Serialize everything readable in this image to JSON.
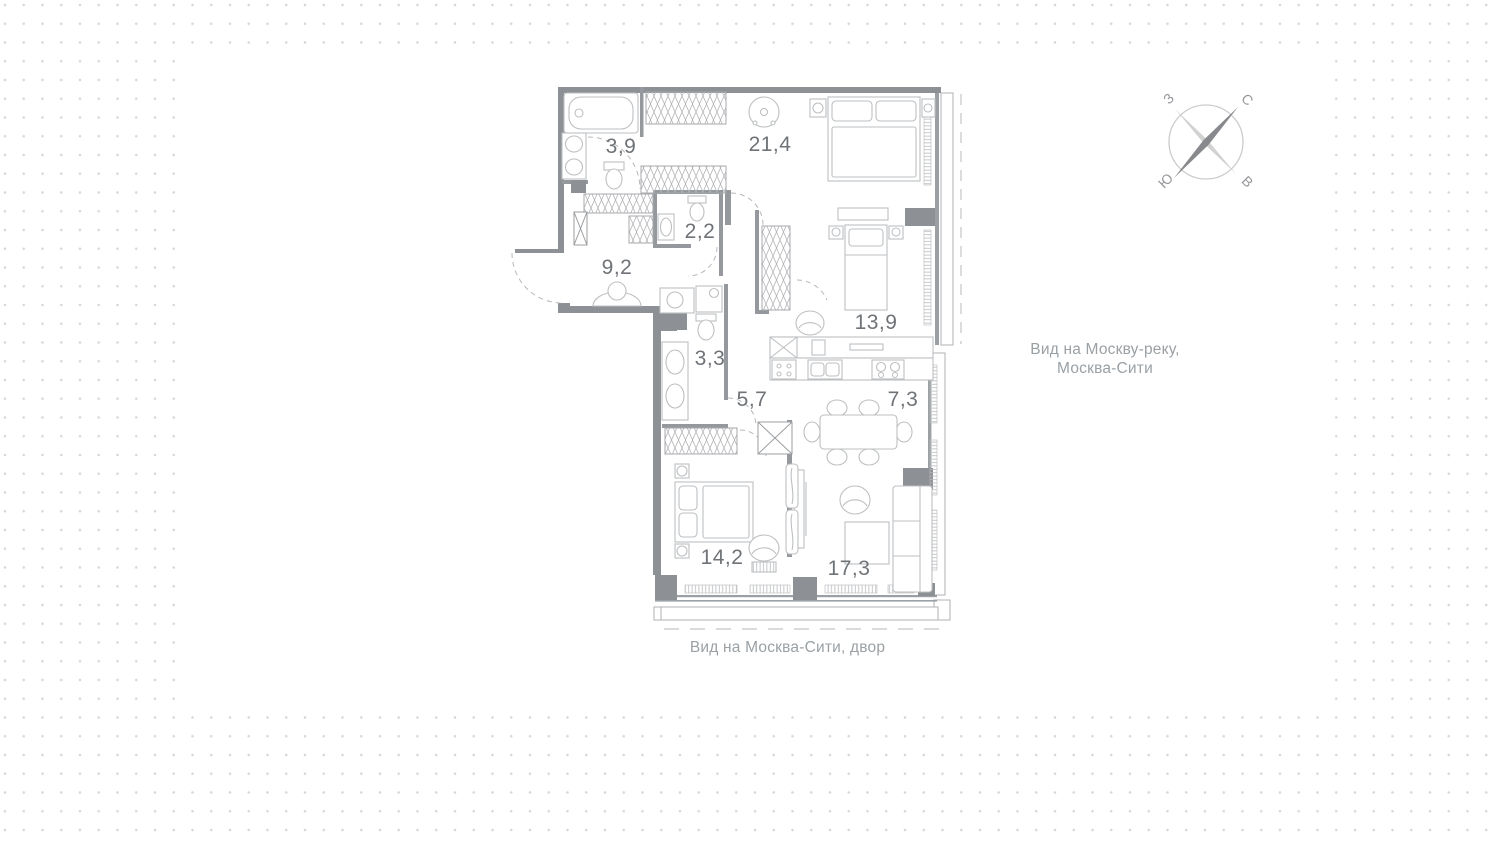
{
  "floor_plan": {
    "rooms": [
      {
        "id": "bathroom",
        "area": "3,9"
      },
      {
        "id": "bedroom-main",
        "area": "21,4"
      },
      {
        "id": "wc",
        "area": "2,2"
      },
      {
        "id": "hallway",
        "area": "9,2"
      },
      {
        "id": "bedroom-2",
        "area": "13,9"
      },
      {
        "id": "bathroom-2",
        "area": "3,3"
      },
      {
        "id": "corridor",
        "area": "5,7"
      },
      {
        "id": "kitchen",
        "area": "7,3"
      },
      {
        "id": "bedroom-3",
        "area": "14,2"
      },
      {
        "id": "living-room",
        "area": "17,3"
      }
    ],
    "views": {
      "right_line1": "Вид на Москву-реку,",
      "right_line2": "Москва-Сити",
      "bottom": "Вид на  Москва-Сити, двор"
    }
  },
  "compass": {
    "north_label": "С",
    "east_label": "В",
    "south_label": "Ю",
    "west_label": "З"
  },
  "colors": {
    "wall": "#8d9094",
    "partition": "#95989c",
    "furniture": "#bdbfc1",
    "dot": "#d7d7d7",
    "label": "#6f7377"
  }
}
